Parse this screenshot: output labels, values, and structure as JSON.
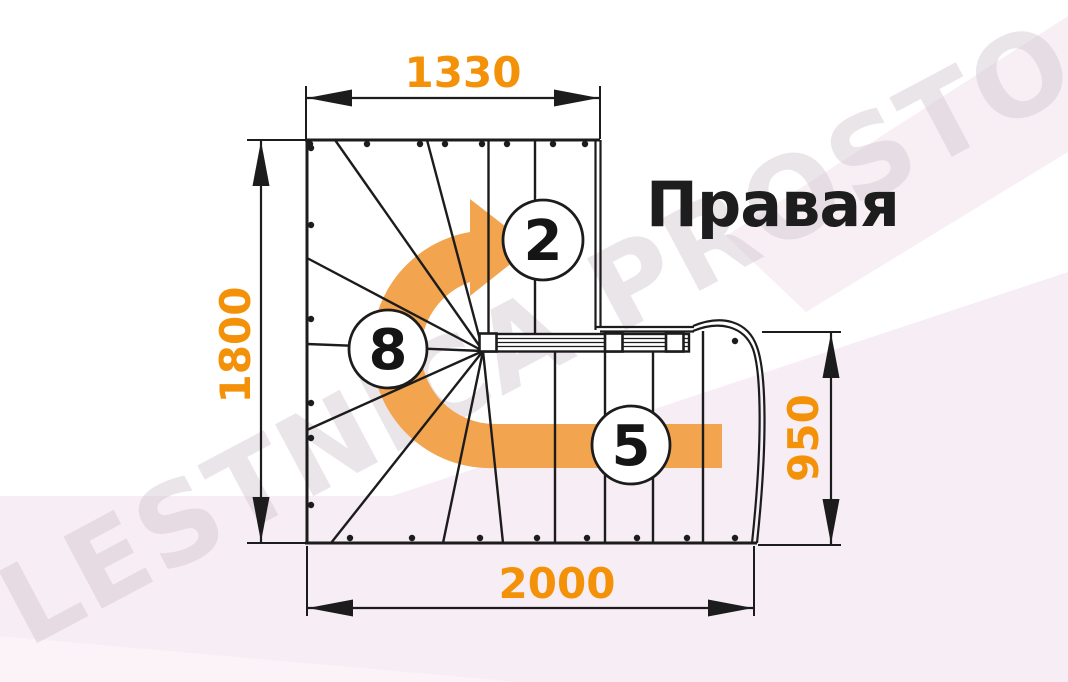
{
  "diagram": {
    "title": "Правая",
    "watermark": "LESTNICA PROSTO.RU",
    "dimensions_mm": {
      "top_width": "1330",
      "left_height": "1800",
      "right_height": "950",
      "bottom_width": "2000"
    },
    "step_counts": {
      "upper_flight": "2",
      "winder_steps": "8",
      "lower_flight": "5"
    },
    "colors": {
      "dimension_text": "#F39208",
      "direction_arrow": "#F2A44E",
      "linework": "#1C1C1C",
      "background_tint": "#F7EDF4",
      "watermark": "#CFC2CC"
    }
  }
}
